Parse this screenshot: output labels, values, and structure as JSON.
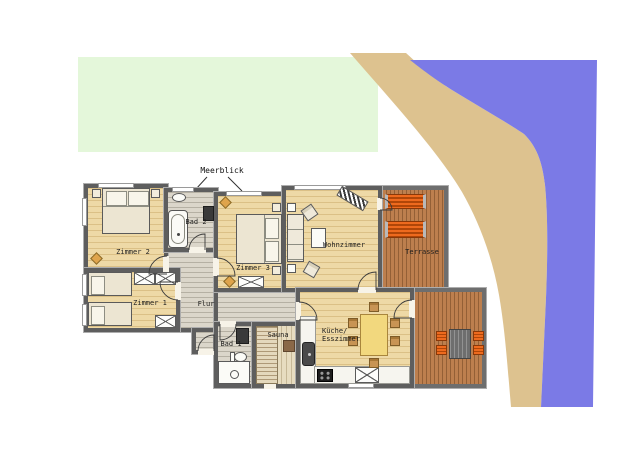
{
  "annotation": {
    "meerblick": "Meerblick"
  },
  "rooms": {
    "zimmer1": {
      "label": "Zimmer 1"
    },
    "zimmer2": {
      "label": "Zimmer 2"
    },
    "zimmer3": {
      "label": "Zimmer 3"
    },
    "bad1": {
      "label": "Bad 1"
    },
    "bad2": {
      "label": "Bad 2"
    },
    "flur": {
      "label": "Flur"
    },
    "sauna": {
      "label": "Sauna"
    },
    "wohnzimmer": {
      "label": "Wohnzimmer"
    },
    "terrasse": {
      "label": "Terrasse"
    },
    "kueche": {
      "label_line1": "Küche/",
      "label_line2": "Esszimmer"
    }
  },
  "colors": {
    "grass": "#e4f7da",
    "sand": "#ddc28f",
    "water": "#7b7ae6",
    "deck": "#bd7f4e",
    "wood": "#eed9a6",
    "corridor": "#dbd6ca",
    "sauna": "#e7dcc0",
    "wall": "#5e5e5e",
    "lounger": "#ee6a1e",
    "table": "#f2d87e"
  }
}
